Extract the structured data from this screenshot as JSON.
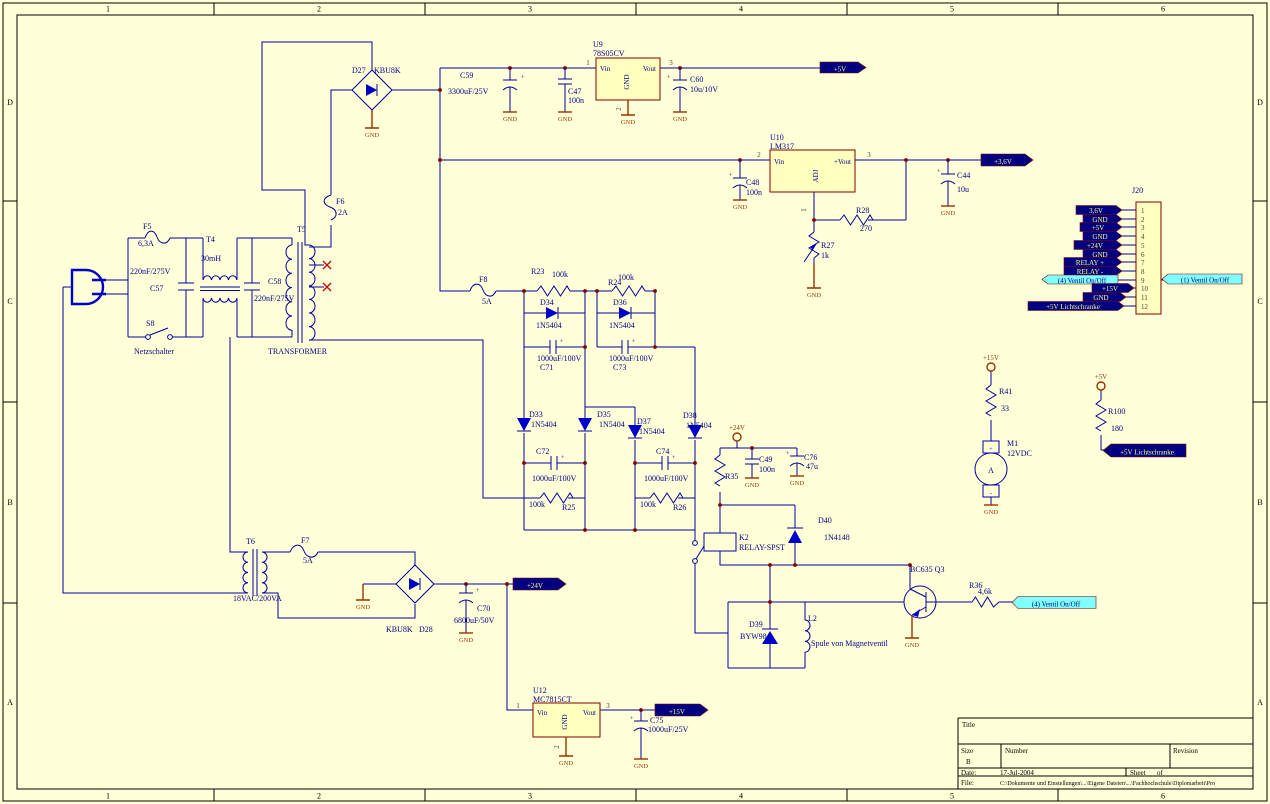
{
  "common": {
    "gnd": "GND",
    "plus": "+"
  },
  "border": {
    "cols": [
      "1",
      "2",
      "3",
      "4",
      "5",
      "6"
    ],
    "rows": [
      "D",
      "C",
      "B",
      "A"
    ]
  },
  "mains": {
    "f5_ref": "F5",
    "f5_val": "6,3A",
    "c57_val": "220nF/275V",
    "c57_ref": "C57",
    "t4_ref": "T4",
    "t4_val": "30mH",
    "c58_ref": "C58",
    "c58_val": "220nF/275V",
    "s8_ref": "S8",
    "s8_val": "Netzschalter",
    "t5_ref": "T5",
    "t5_val": "TRANSFORMER",
    "f6_ref": "F6",
    "f6_val": "2A"
  },
  "psu5": {
    "d27_ref": "D27",
    "d27_val": "KBU8K",
    "c59_ref": "C59",
    "c59_val": "3300uF/25V",
    "u9_ref": "U9",
    "u9_val": "78S05CV",
    "u9_vin": "Vin",
    "u9_gnd": "GND",
    "u9_vout": "Vout",
    "u9_p1": "1",
    "u9_p2": "2",
    "u9_p3": "3",
    "c47_ref": "C47",
    "c47_val": "100n",
    "c60_ref": "C60",
    "c60_val": "10u/10V",
    "flag_5v": "+5V"
  },
  "psu36": {
    "u10_ref": "U10",
    "u10_val": "LM317",
    "u10_vin": "Vin",
    "u10_vout": "+Vout",
    "u10_adj": "ADJ",
    "p1": "1",
    "p2": "2",
    "p3": "3",
    "c48_ref": "C48",
    "c48_val": "100n",
    "r28_ref": "R28",
    "r28_val": "270",
    "r27_ref": "R27",
    "r27_val": "1k",
    "c44_ref": "C44",
    "c44_val": "10u",
    "flag_36v": "+3,6V"
  },
  "hv": {
    "f8_ref": "F8",
    "f8_val": "5A",
    "r23_ref": "R23",
    "r23_val": "100k",
    "r24_ref": "R24",
    "r24_val": "100k",
    "d34_ref": "D34",
    "d34_val": "1N5404",
    "d36_ref": "D36",
    "d36_val": "1N5404",
    "c71_ref": "C71",
    "c71_val": "1000uF/100V",
    "c73_ref": "C73",
    "c73_val": "1000uF/100V",
    "d33_ref": "D33",
    "d33_val": "1N5404",
    "d35_ref": "D35",
    "d35_val": "1N5404",
    "d37_ref": "D37",
    "d37_val": "1N5404",
    "d38_ref": "D38",
    "d38_val": "1N5404",
    "c72_ref": "C72",
    "c72_val": "1000uF/100V",
    "c74_ref": "C74",
    "c74_val": "1000uF/100V",
    "r25_ref": "R25",
    "r25_val": "100k",
    "r26_ref": "R26",
    "r26_val": "100k",
    "port_24v": "+24V"
  },
  "relay": {
    "r35_ref": "R35",
    "c49_ref": "C49",
    "c49_val": "100n",
    "c76_ref": "C76",
    "c76_val": "47u",
    "k2_ref": "K2",
    "k2_val": "RELAY-SPST",
    "d40_ref": "D40",
    "d40_val": "1N4148",
    "d39_ref": "D39",
    "d39_val": "BYW98",
    "l2_ref": "L2",
    "l2_val": "Spule von Magnetventil",
    "q3_ref": "BC635  Q3",
    "r36_ref": "R36",
    "r36_val": "4,6k",
    "flag_valve": "(4) Ventil On/Off"
  },
  "psu24": {
    "t6_ref": "T6",
    "t6_val": "18VAC/200VA",
    "f7_ref": "F7",
    "f7_val": "5A",
    "d28_val": "KBU8K",
    "d28_ref": "D28",
    "c70_ref": "C70",
    "c70_val": "6800uF/50V",
    "flag_24v": "+24V"
  },
  "psu15": {
    "u12_ref": "U12",
    "u12_val": "MC7815CT",
    "vin": "Vin",
    "gnd": "GND",
    "vout": "Vout",
    "p1": "1",
    "p2": "2",
    "p3": "3",
    "c75_ref": "C75",
    "c75_val": "1000uF/25V",
    "flag_15v": "+15V"
  },
  "motor": {
    "port_15v": "+15V",
    "r41_ref": "R41",
    "r41_val": "33",
    "m1_ref": "M1",
    "m1_val": "12VDC",
    "m1_sym": "A",
    "plus": "+",
    "minus": "-"
  },
  "lichtschranke": {
    "port_5v": "+5V",
    "r100_ref": "R100",
    "r100_val": "180",
    "flag": "+5V Lichtschranke"
  },
  "j20": {
    "ref": "J20",
    "pins": [
      "1",
      "2",
      "3",
      "4",
      "5",
      "6",
      "7",
      "8",
      "9",
      "10",
      "11",
      "12"
    ],
    "flags": [
      "3,6V",
      "GND",
      "+5V",
      "GND",
      "+24V",
      "GND",
      "RELAY +",
      "RELAY -"
    ],
    "flag9": "(4) Ventil On/Off",
    "flag10": "+15V",
    "flag11": "GND",
    "flag12": "+5V Lichtschranke",
    "flag_right": "(1) Ventil On/Off"
  },
  "title_block": {
    "title_label": "Title",
    "size_label": "Size",
    "size_value": "B",
    "number_label": "Number",
    "revision_label": "Revision",
    "date_label": "Date:",
    "date_value": "17-Jul-2004",
    "sheet_label": "Sheet",
    "of_label": "of",
    "file_label": "File:",
    "file_value": "C:\\Dokumente und Einstellungen\\...\\Eigene Dateien\\...\\Fachhochschule\\Diplomarbeit\\Pro"
  }
}
